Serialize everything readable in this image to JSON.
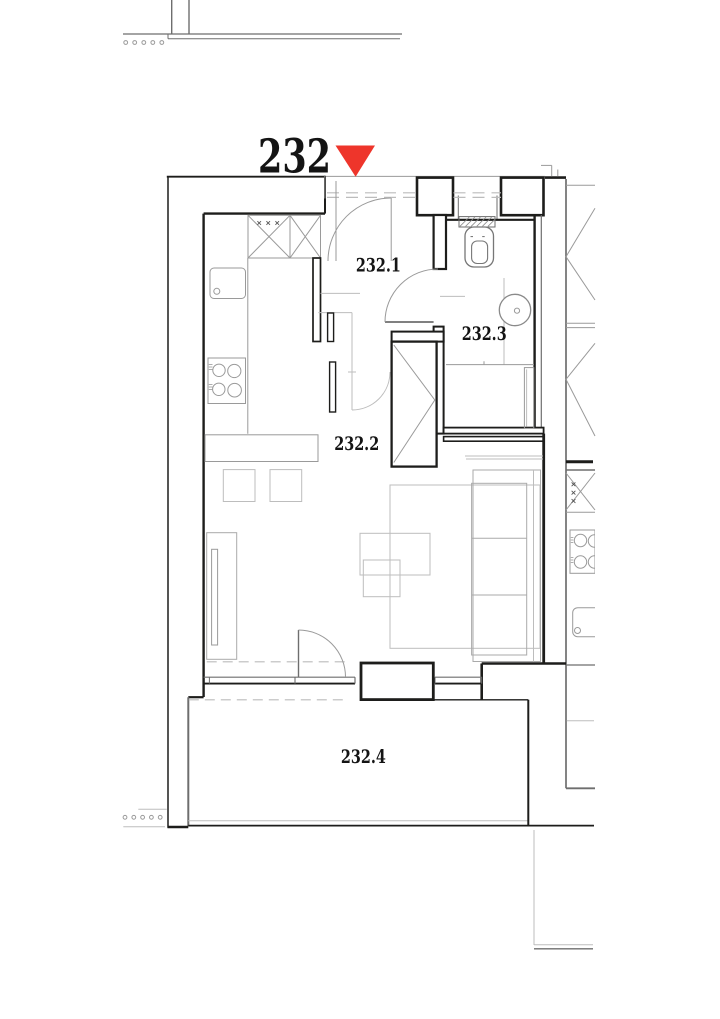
{
  "title": "Apartment floor plan",
  "unit": {
    "label": "232"
  },
  "rooms": [
    {
      "key": "hall",
      "label": "232.1"
    },
    {
      "key": "living-kitchen",
      "label": "232.2"
    },
    {
      "key": "bathroom",
      "label": "232.3"
    },
    {
      "key": "balcony",
      "label": "232.4"
    }
  ],
  "icons": {
    "entrance_marker": "red-triangle-down",
    "wardrobe": "crossed-box",
    "kitchen_cabinets": "x-box",
    "stove": "four-burner-cooktop",
    "sink": "rounded-basin",
    "toilet": "wc",
    "washbasin": "round-basin"
  },
  "colors": {
    "entrance_marker": "#ee352b",
    "wall": "#1d1d1b",
    "fixture_line": "#9a9a9a",
    "light_line": "#bdbdbd",
    "context_line": "#6e6e6e",
    "label_text": "#141414"
  }
}
